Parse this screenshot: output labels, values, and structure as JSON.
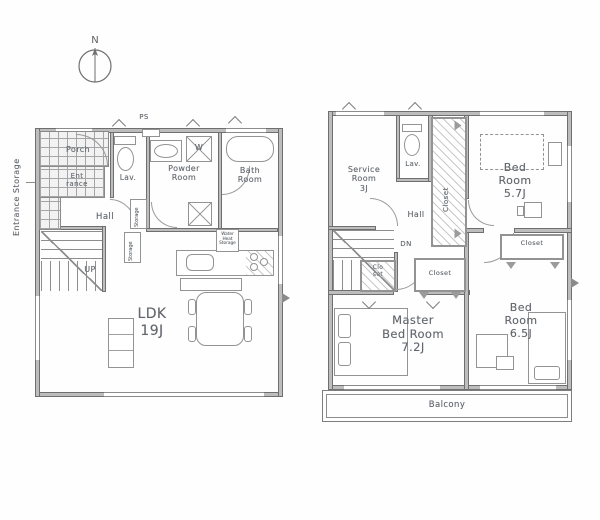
{
  "compass": {
    "north_label": "N"
  },
  "floor1": {
    "side_label": "Entrance Storage",
    "ps_label": "PS",
    "porch": "Porch",
    "entrance": "Ent\nrance",
    "lav": "Lav.",
    "powder_room": "Powder\nRoom",
    "washer": "W",
    "bath_room": "Bath\nRoom",
    "hall": "Hall",
    "storage_upper": "Storage",
    "storage_lower": "Storage",
    "up": "UP",
    "water_heater": "Water\nHeat\nStorage",
    "ldk": "LDK\n19J"
  },
  "floor2": {
    "service_room": "Service\nRoom\n3J",
    "lav": "Lav.",
    "closet_hall": "Closet",
    "bed_room_1": "Bed\nRoom\n5.7J",
    "hall": "Hall",
    "dn": "DN",
    "closet_small": "Clo\nset",
    "closet_mid": "Closet",
    "closet_bed2": "Closet",
    "master_bed_room": "Master\nBed Room\n7.2J",
    "bed_room_2": "Bed\nRoom\n6.5J",
    "balcony": "Balcony"
  }
}
